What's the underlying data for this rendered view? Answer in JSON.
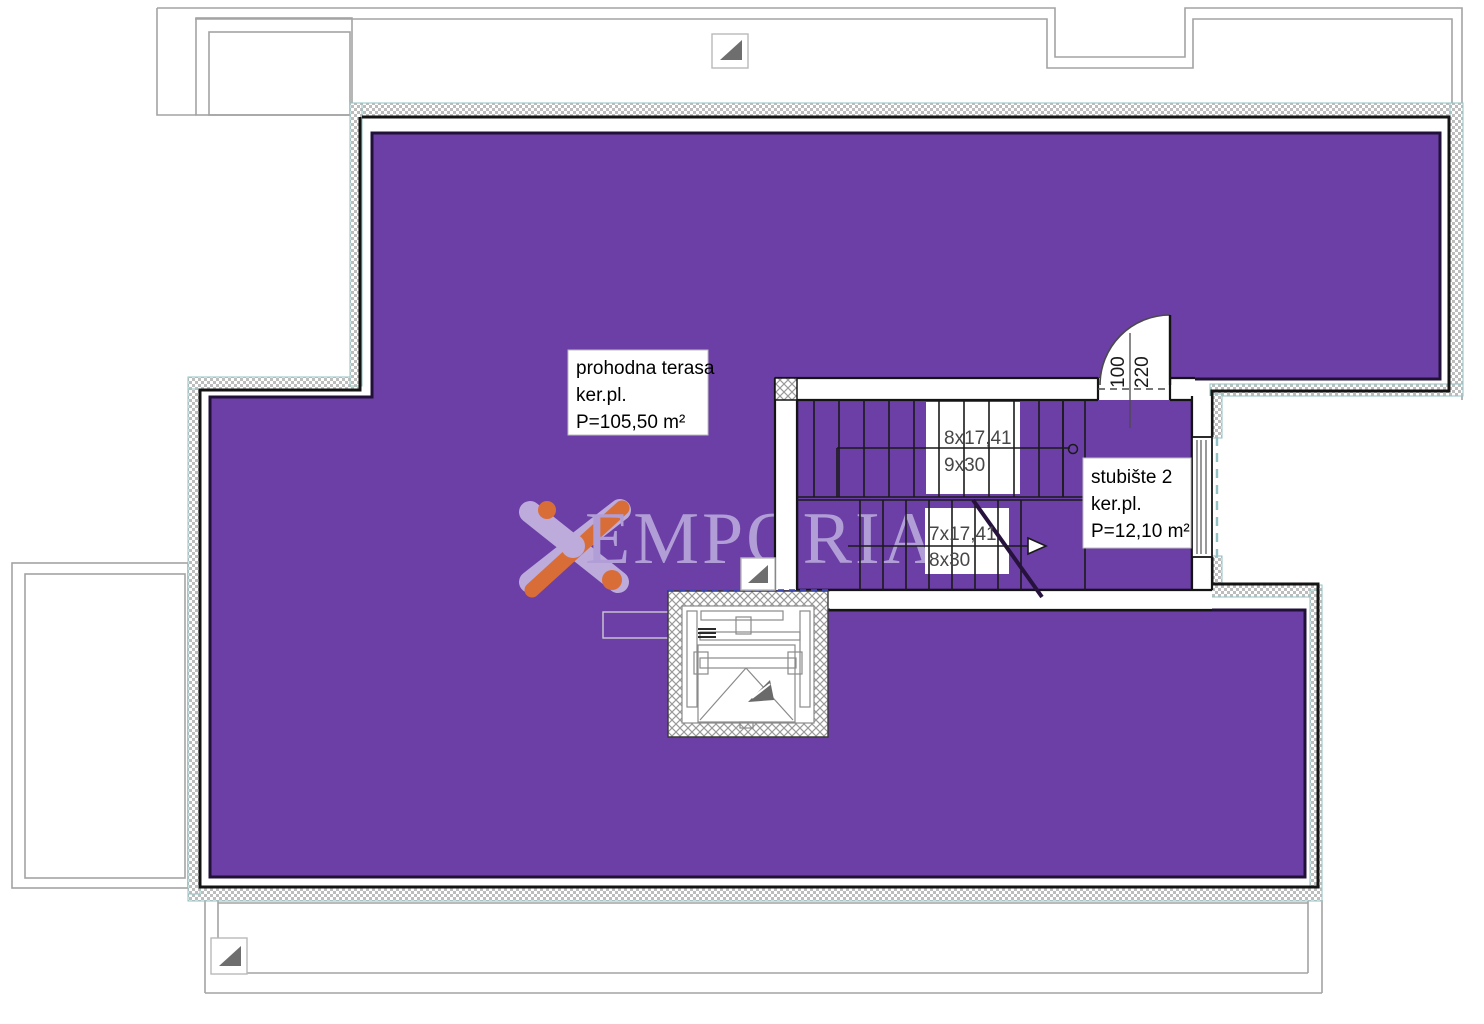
{
  "plan": {
    "type": "floor-plan",
    "floor_name": "terrace level",
    "rooms": [
      {
        "id": "terrace",
        "label": {
          "line1": "prohodna terasa",
          "line2": "ker.pl.",
          "line3": "P=105,50 m²"
        },
        "area_m2": "105,50",
        "fill": "#6b3fa6"
      },
      {
        "id": "staircase-2",
        "label": {
          "line1": "stubište 2",
          "line2": "ker.pl.",
          "line3": "P=12,10 m²"
        },
        "area_m2": "12,10",
        "fill": "#6b3fa6"
      }
    ],
    "stairs": {
      "upper_flight": {
        "line1": "8x17,41",
        "line2": "9x30"
      },
      "lower_flight": {
        "line1": "7x17,41",
        "line2": "8x30"
      }
    },
    "door": {
      "width_cm": "100",
      "height_cm": "220"
    }
  },
  "watermark": {
    "text": "EMPORIA",
    "text_color": "#b7a6da",
    "logo_lavender": "#c3b4e0",
    "logo_orange": "#e2712f"
  },
  "colors": {
    "room_fill": "#6b3fa6",
    "room_edge": "#211038",
    "wall_line": "#141414",
    "insulation_teal": "#93c2c4",
    "hatch_gray": "#b9b9b9",
    "roof_outline_gray": "#a3a3a3",
    "stair_text": "#474747",
    "label_text": "#000000"
  },
  "icons": {
    "placeholder_1": "image-placeholder",
    "placeholder_2": "image-placeholder",
    "placeholder_3": "image-placeholder"
  }
}
